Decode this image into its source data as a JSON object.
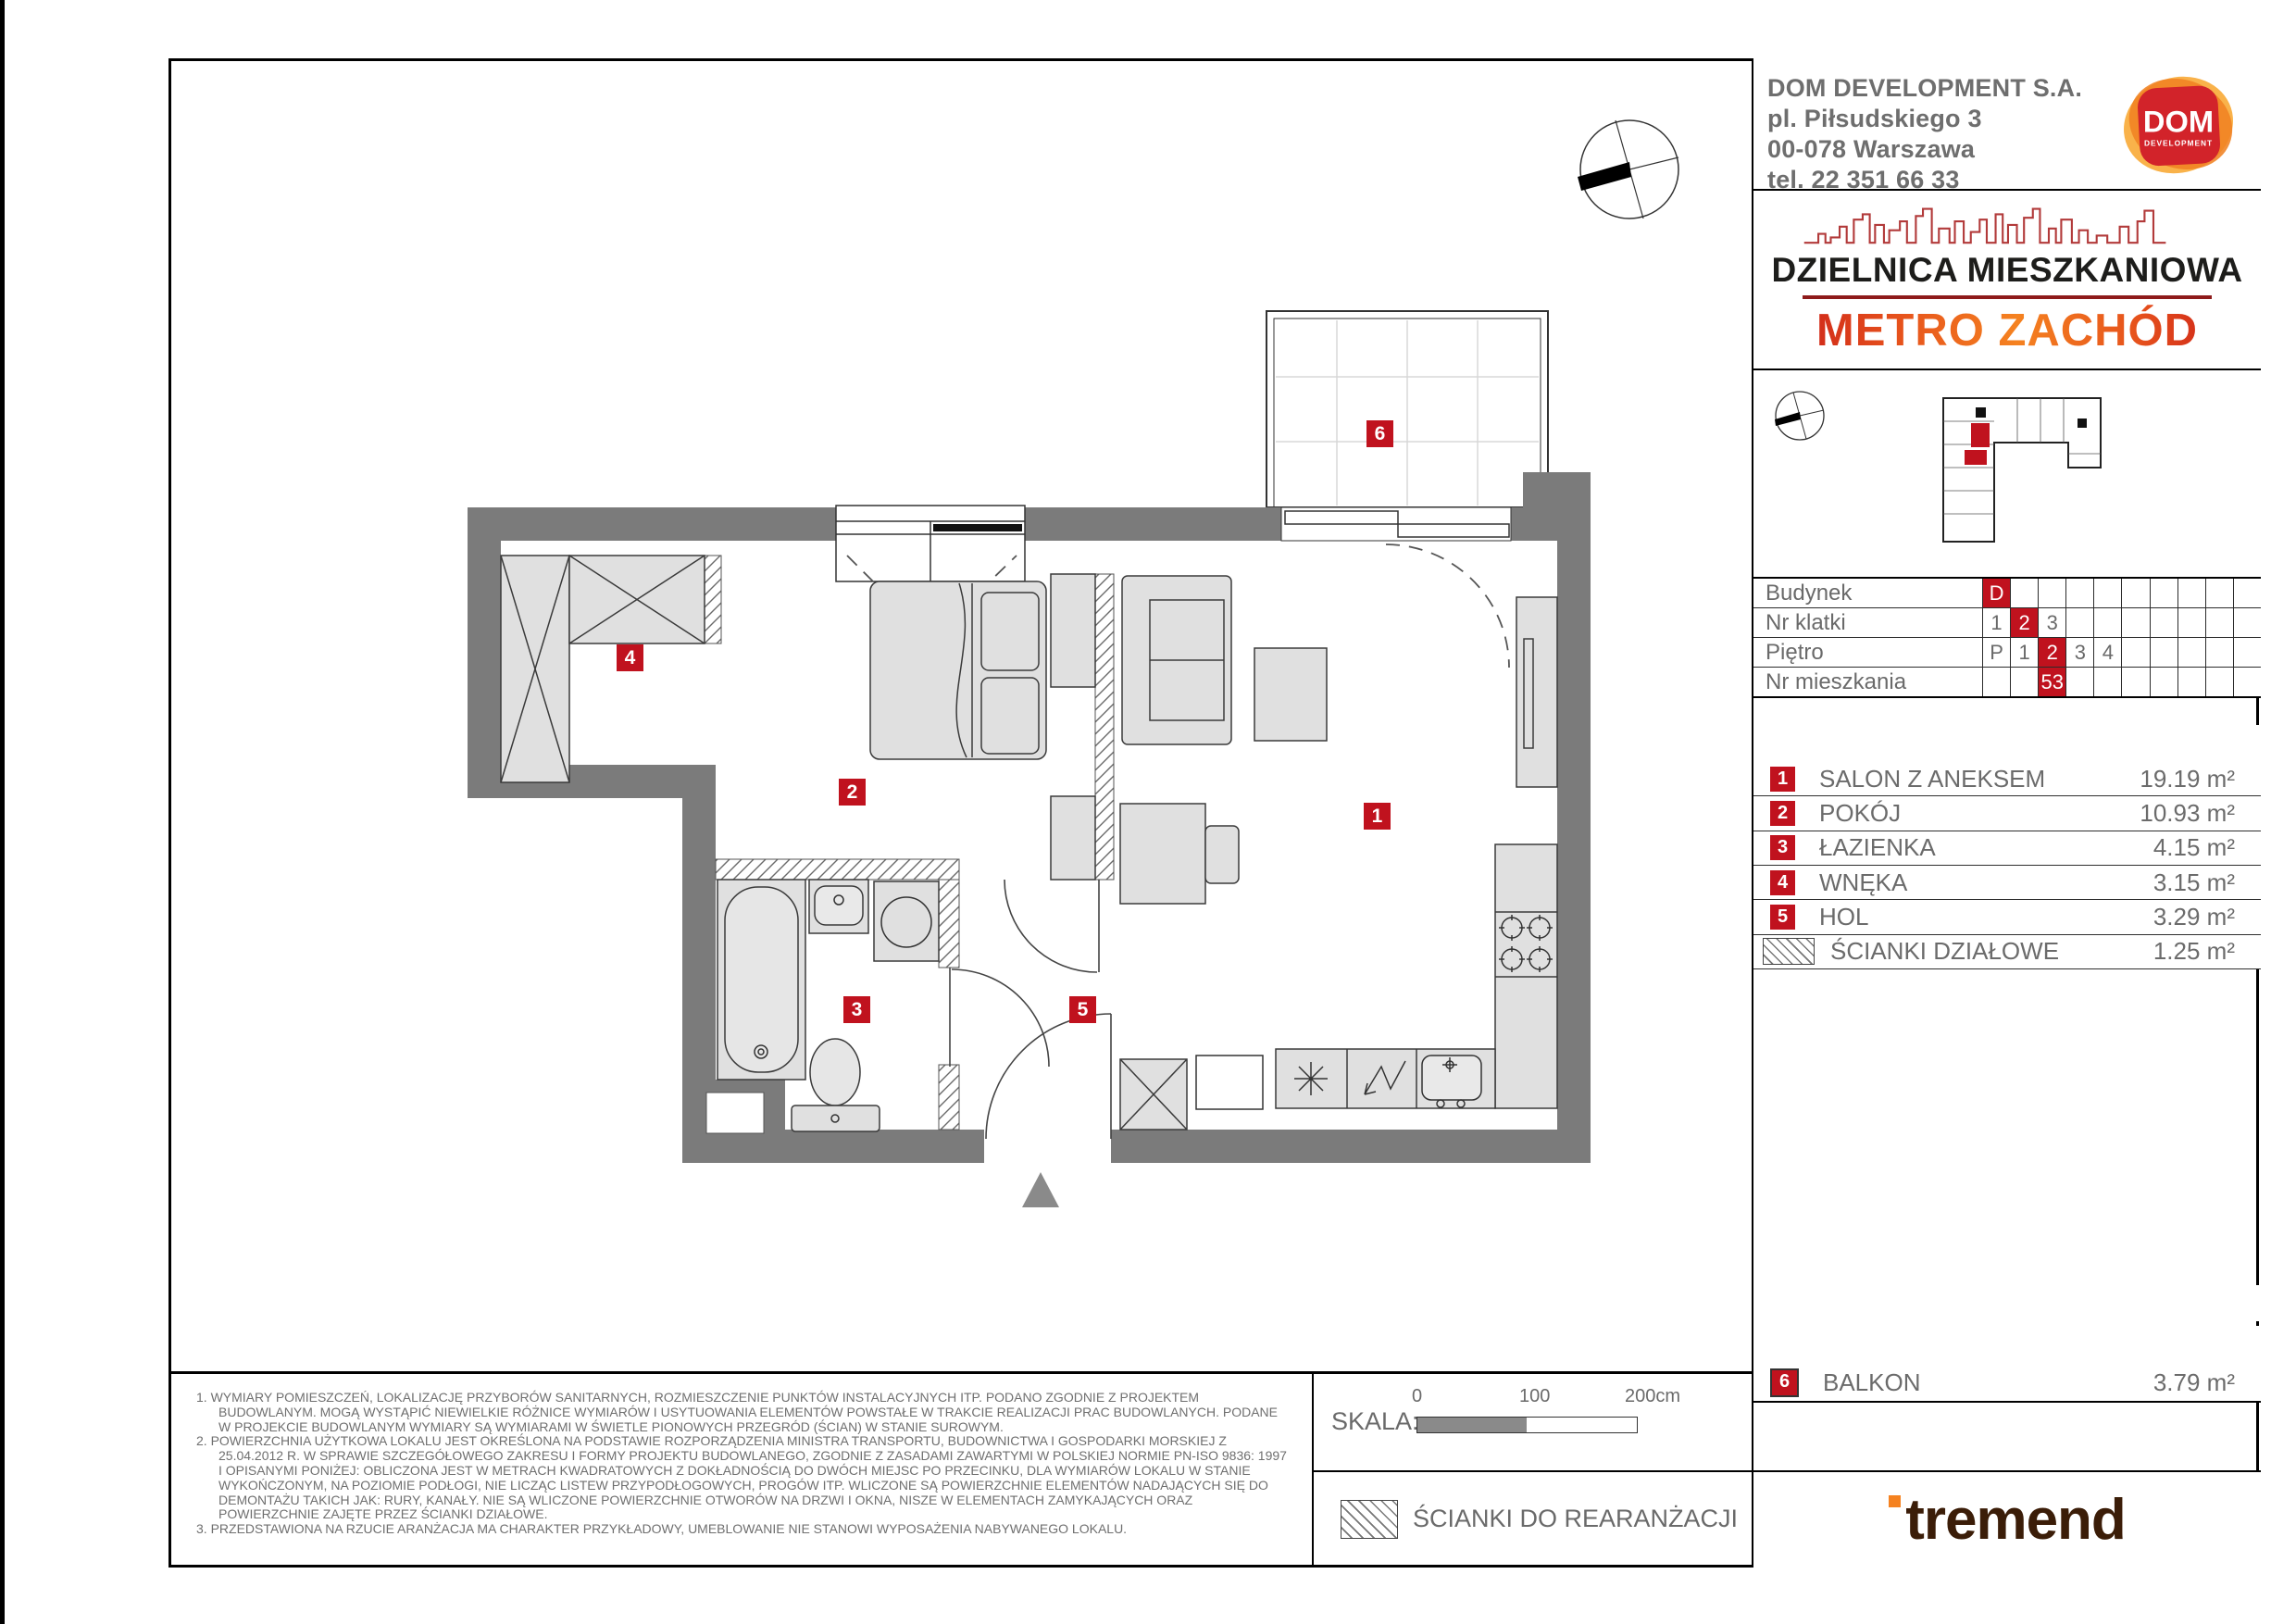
{
  "colors": {
    "accent_red": "#c0121e",
    "wall_gray": "#7b7b7b",
    "text_gray": "#6b6b6b",
    "logo_orange": "#f58220",
    "logo_red": "#d2232a",
    "tremend_brown": "#3b1d08"
  },
  "header": {
    "company": "DOM DEVELOPMENT S.A.",
    "address1": "pl. Piłsudskiego 3",
    "address2": "00-078 Warszawa",
    "phone": "tel. 22 351 66 33",
    "logo_line1": "DOM",
    "logo_line2": "DEVELOPMENT"
  },
  "brand": {
    "line1": "DZIELNICA MIESZKANIOWA",
    "line2": "METRO ZACHÓD"
  },
  "location_table": {
    "rows": [
      {
        "label": "Budynek",
        "cells": [
          "D",
          "",
          "",
          "",
          "",
          "",
          "",
          "",
          "",
          ""
        ]
      },
      {
        "label": "Nr klatki",
        "cells": [
          "1",
          "2",
          "3",
          "",
          "",
          "",
          "",
          "",
          "",
          ""
        ]
      },
      {
        "label": "Piętro",
        "cells": [
          "P",
          "1",
          "2",
          "3",
          "4",
          "",
          "",
          "",
          "",
          ""
        ]
      },
      {
        "label": "Nr mieszkania",
        "cells": [
          "",
          "",
          "53",
          "",
          "",
          "",
          "",
          "",
          "",
          ""
        ]
      }
    ]
  },
  "rooms": {
    "header": "ZESTAWIENIE POMIESZCZEŃ:",
    "items": [
      {
        "num": "1",
        "name": "SALON Z ANEKSEM",
        "area": "19.19 m²"
      },
      {
        "num": "2",
        "name": "POKÓJ",
        "area": "10.93 m²"
      },
      {
        "num": "3",
        "name": "ŁAZIENKA",
        "area": "4.15 m²"
      },
      {
        "num": "4",
        "name": "WNĘKA",
        "area": "3.15 m²"
      },
      {
        "num": "5",
        "name": "HOL",
        "area": "3.29 m²"
      },
      {
        "num": "",
        "name": "ŚCIANKI DZIAŁOWE",
        "area": "1.25 m²"
      }
    ]
  },
  "summary": {
    "usable_label": "POWIERZCHNIA UŻYTKOWA:",
    "usable_value": "40.71",
    "real_label": "POWIERZCHNIA RZECZYWISTA:",
    "real_value": "41.96",
    "balcony": {
      "num": "6",
      "name": "BALKON",
      "area": "3.79 m²"
    }
  },
  "plan": {
    "badges": [
      {
        "num": "1"
      },
      {
        "num": "2"
      },
      {
        "num": "3"
      },
      {
        "num": "4"
      },
      {
        "num": "5"
      },
      {
        "num": "6"
      }
    ]
  },
  "footer": {
    "notes": [
      "1. WYMIARY POMIESZCZEŃ, LOKALIZACJĘ PRZYBORÓW SANITARNYCH, ROZMIESZCZENIE PUNKTÓW INSTALACYJNYCH ITP. PODANO ZGODNIE Z PROJEKTEM BUDOWLANYM. MOGĄ WYSTĄPIĆ NIEWIELKIE RÓŻNICE WYMIARÓW I USYTUOWANIA ELEMENTÓW POWSTAŁE W TRAKCIE REALIZACJI PRAC BUDOWLANYCH. PODANE W PROJEKCIE BUDOWLANYM WYMIARY SĄ WYMIARAMI W ŚWIETLE PIONOWYCH PRZEGRÓD (ŚCIAN) W STANIE SUROWYM.",
      "2. POWIERZCHNIA UŻYTKOWA LOKALU JEST OKREŚLONA NA PODSTAWIE ROZPORZĄDZENIA MINISTRA TRANSPORTU, BUDOWNICTWA I GOSPODARKI MORSKIEJ Z 25.04.2012 R. W SPRAWIE SZCZEGÓŁOWEGO ZAKRESU I FORMY PROJEKTU BUDOWLANEGO, ZGODNIE Z ZASADAMI ZAWARTYMI W POLSKIEJ NORMIE PN-ISO 9836: 1997 I OPISANYMI PONIŻEJ: OBLICZONA JEST W METRACH KWADRATOWYCH Z DOKŁADNOŚCIĄ DO DWÓCH MIEJSC PO PRZECINKU, DLA WYMIARÓW LOKALU W STANIE WYKOŃCZONYM, NA POZIOMIE PODŁOGI, NIE LICZĄC LISTEW PRZYPODŁOGOWYCH, PROGÓW ITP. WLICZONE SĄ POWIERZCHNIE ELEMENTÓW NADAJĄCYCH SIĘ DO DEMONTAŻU TAKICH JAK: RURY, KANAŁY. NIE SĄ WLICZONE POWIERZCHNIE OTWORÓW NA DRZWI I OKNA, NISZE W ELEMENTACH ZAMYKAJĄCYCH ORAZ POWIERZCHNIE ZAJĘTE PRZEZ ŚCIANKI DZIAŁOWE.",
      "3. PRZEDSTAWIONA NA RZUCIE ARANŻACJA MA CHARAKTER PRZYKŁADOWY, UMEBLOWANIE NIE STANOWI WYPOSAŻENIA NABYWANEGO LOKALU."
    ],
    "scale_label": "SKALA:",
    "scale_ticks": [
      "0",
      "100",
      "200cm"
    ],
    "legend_label": "ŚCIANKI DO REARANŻACJI"
  },
  "tremend": {
    "logo_text": "tremend"
  }
}
